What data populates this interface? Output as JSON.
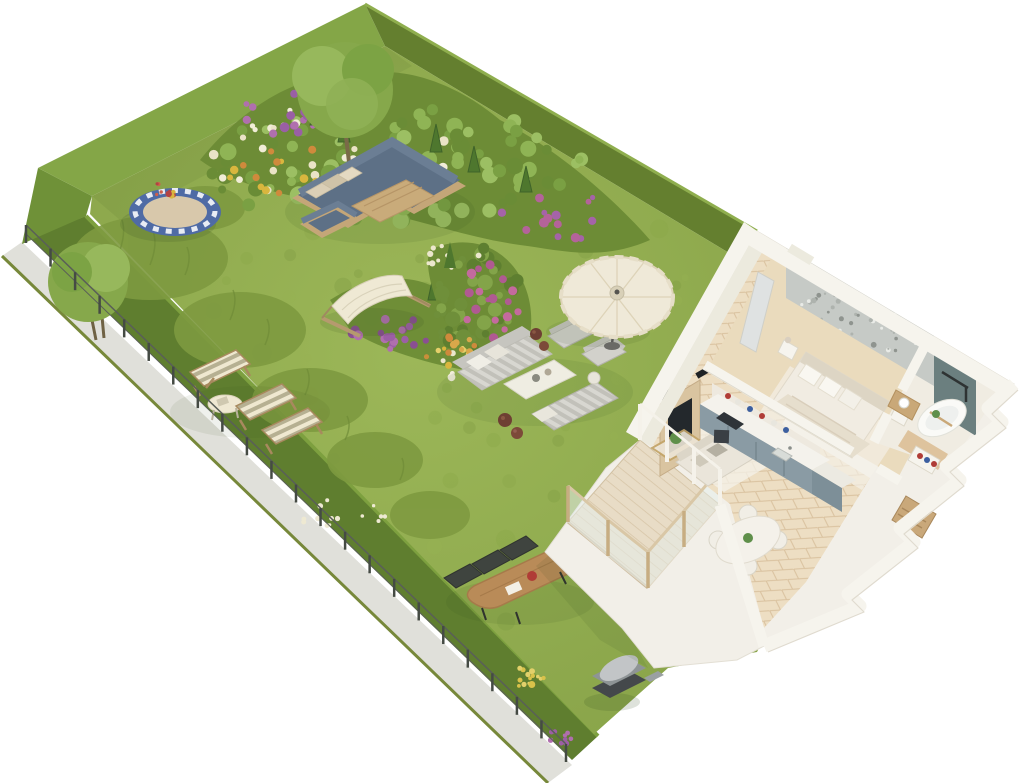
{
  "scene": {
    "kind": "isometric-3d-floor-plan-render",
    "background": "#ffffff"
  },
  "colors": {
    "lawn": "#93ad4f",
    "lawn_light": "#9cb758",
    "hedge_bright": "#84a647",
    "hedge_mid": "#6f9138",
    "hedge_dark": "#647f2f",
    "hedge_low": "#5f7e2f",
    "path": "#e0e0da",
    "path_edge": "#77883a",
    "fence_post": "#454b44",
    "fence_rail": "#5a5f58",
    "bed_base": "#6d8c36",
    "conifer": "#4e772e",
    "tree_canopy": "#86a84b",
    "tree_canopy_light": "#97b85c",
    "trunk": "#7a6a48",
    "tall_grass": "#7e9a40",
    "trampoline_rim": "#4f6ba5",
    "trampoline_mat": "#d8c8ab",
    "sofa_blue": "#5d7086",
    "sofa_blue_back": "#6b7e94",
    "wood_frame": "#c4a678",
    "wood_table": "#c9ab7a",
    "pillow_beige": "#dbcfb6",
    "hammock_canvas": "#efe9d4",
    "lounge_gray": "#d2d1cb",
    "lounge_back": "#c6c5bf",
    "pot_brown": "#6e3f33",
    "umbrella_canvas": "#efe9d8",
    "deckchair_cream": "#efe8d0",
    "deckchair_olive": "#b6b092",
    "garden_table_wood": "#b98b58",
    "garden_chair_dark": "#3f443f",
    "teapot_red": "#b03c36",
    "grill_dark": "#44484b",
    "grill_hood": "#c2c5c7",
    "wall_top": "#f6f4ed",
    "wall_face": "#eceade",
    "house_base": "#f2efe8",
    "floor_parquet": "#eddec3",
    "floor_line": "#d9c19e",
    "deck": "#e8dcc6",
    "glass": "#e6efec",
    "railing_wood": "#c7ad82",
    "kitchen_cabinet": "#8a9ba4",
    "kitchen_island": "#7d8f98",
    "counter": "#f4f2ec",
    "appliance_dark": "#2e3338",
    "accent_wall": "#c6cac6",
    "bed_linen": "#f1ece2",
    "blanket": "#e6decd",
    "headboard": "#ddd5c4",
    "rug": "#f4f1ea",
    "slate_wall": "#6b7f7f",
    "tub_white": "#fafaf7",
    "vanity_wood": "#c9a878",
    "closet_wood": "#c9a87a",
    "mirror": "#dfe2e2",
    "sofa_cream": "#eae5da",
    "tv_dark": "#23282c",
    "tv_panel_wood": "#d9c4a0",
    "dining_white": "#f4f1ea",
    "plant_green": "#5f8f4a",
    "shadow": "#2f4a1f"
  },
  "garden": {
    "items": [
      "perimeter-hedge",
      "perimeter-path",
      "wire-fence",
      "lawn",
      "flower-bed-top",
      "flower-bed-middle",
      "flower-bed-right",
      "tree-top",
      "tree-left",
      "trampoline",
      "corner-sofa-set",
      "outdoor-coffee-table",
      "outdoor-armchair",
      "hammock",
      "lounge-sofa",
      "lounge-armchairs",
      "lounge-table",
      "sun-lounger",
      "clay-pots",
      "parasol-umbrella",
      "deck-chairs",
      "side-table",
      "garden-dining-table",
      "garden-dining-chairs",
      "barbecue-grill"
    ]
  },
  "apartment": {
    "rooms": [
      "living-room",
      "kitchen",
      "dining-area",
      "bedroom",
      "bathroom",
      "hallway",
      "terrace"
    ],
    "furniture": [
      "tv-wall-unit",
      "sofa",
      "coffee-table",
      "round-dining-table",
      "kitchen-counter",
      "cooktop",
      "oven",
      "sink",
      "double-bed",
      "nightstands",
      "wardrobe-mirror",
      "freestanding-bathtub",
      "shower-fixture",
      "vanity-basin",
      "towel-niche",
      "closet-nook",
      "glass-balustrade"
    ]
  },
  "decorations": {
    "fence": {
      "x1": 26,
      "y1": 243,
      "x2": 566,
      "y2": 762,
      "posts": 22,
      "height": 18
    },
    "clusters": [
      {
        "target": "bed-top-green",
        "cx": 390,
        "cy": 165,
        "rx": 195,
        "ry": 58,
        "count": 90,
        "rmin": 4,
        "rmax": 9,
        "colors": [
          "#7aa043",
          "#8fb455",
          "#6a8c36",
          "#9cbf63"
        ],
        "seed": 7
      },
      {
        "target": "bed-top-cream",
        "cx": 330,
        "cy": 150,
        "rx": 150,
        "ry": 45,
        "count": 40,
        "rmin": 2.5,
        "rmax": 5,
        "colors": [
          "#eae3c6",
          "#f1edd7"
        ],
        "seed": 11
      },
      {
        "target": "bed-top-purple",
        "cx": 296,
        "cy": 116,
        "rx": 58,
        "ry": 24,
        "count": 16,
        "rmin": 2.5,
        "rmax": 5,
        "colors": [
          "#9a5fa5",
          "#b06fae"
        ],
        "seed": 13
      },
      {
        "target": "bed-top-yellow",
        "cx": 300,
        "cy": 172,
        "rx": 85,
        "ry": 26,
        "count": 22,
        "rmin": 2.5,
        "rmax": 4.5,
        "colors": [
          "#d9b63e",
          "#cf8a3c"
        ],
        "seed": 17
      },
      {
        "target": "bed-top-purple2",
        "cx": 556,
        "cy": 214,
        "rx": 55,
        "ry": 28,
        "count": 14,
        "rmin": 2.5,
        "rmax": 5,
        "colors": [
          "#a563a8",
          "#b4639a"
        ],
        "seed": 19
      },
      {
        "target": "bed-mid-purple",
        "cx": 392,
        "cy": 332,
        "rx": 44,
        "ry": 20,
        "count": 20,
        "rmin": 2.5,
        "rmax": 5,
        "colors": [
          "#9c5fa5",
          "#8a4f92",
          "#b06fae"
        ],
        "seed": 23
      },
      {
        "target": "bed-mid-yellow",
        "cx": 448,
        "cy": 348,
        "rx": 40,
        "ry": 18,
        "count": 18,
        "rmin": 2,
        "rmax": 4,
        "colors": [
          "#d9b63e",
          "#c98f3a",
          "#e5cf6a"
        ],
        "seed": 29
      },
      {
        "target": "bed-mid-white",
        "cx": 472,
        "cy": 366,
        "rx": 34,
        "ry": 16,
        "count": 14,
        "rmin": 2,
        "rmax": 4,
        "colors": [
          "#ece7cd",
          "#f2eedb"
        ],
        "seed": 31
      },
      {
        "target": "bed-right-green",
        "cx": 472,
        "cy": 298,
        "rx": 48,
        "ry": 52,
        "count": 46,
        "rmin": 3.5,
        "rmax": 8,
        "colors": [
          "#6f8f3a",
          "#83a449",
          "#5e7f30"
        ],
        "seed": 37
      },
      {
        "target": "bed-right-magenta",
        "cx": 494,
        "cy": 300,
        "rx": 32,
        "ry": 38,
        "count": 18,
        "rmin": 2.5,
        "rmax": 5,
        "colors": [
          "#b05a92",
          "#c46a9e"
        ],
        "seed": 41
      },
      {
        "target": "bed-right-orange",
        "cx": 470,
        "cy": 348,
        "rx": 32,
        "ry": 18,
        "count": 13,
        "rmin": 2,
        "rmax": 4,
        "colors": [
          "#cf8a3c",
          "#d9a84a"
        ],
        "seed": 43
      },
      {
        "target": "bed-right-white",
        "cx": 452,
        "cy": 256,
        "rx": 28,
        "ry": 16,
        "count": 10,
        "rmin": 2,
        "rmax": 3.5,
        "colors": [
          "#ece7cd"
        ],
        "seed": 47
      },
      {
        "target": "trampoline-flowers",
        "cx": 170,
        "cy": 189,
        "rx": 20,
        "ry": 8,
        "count": 10,
        "rmin": 1.5,
        "rmax": 3.5,
        "colors": [
          "#b34343",
          "#cf5f4a",
          "#d9b63e"
        ],
        "seed": 53
      },
      {
        "target": "bottom-yellow",
        "cx": 520,
        "cy": 678,
        "rx": 24,
        "ry": 10,
        "count": 14,
        "rmin": 1.5,
        "rmax": 3.5,
        "colors": [
          "#d9c24a",
          "#e2d06a"
        ],
        "seed": 59
      },
      {
        "target": "bottom-purple",
        "cx": 562,
        "cy": 736,
        "rx": 15,
        "ry": 8,
        "count": 10,
        "rmin": 1.5,
        "rmax": 3,
        "colors": [
          "#9c5fa5",
          "#b06fae"
        ],
        "seed": 61
      },
      {
        "target": "hedge-specks",
        "cx": 330,
        "cy": 516,
        "rx": 65,
        "ry": 16,
        "count": 14,
        "rmin": 1.5,
        "rmax": 3,
        "colors": [
          "#eee9d2"
        ],
        "seed": 67
      },
      {
        "target": "accent-wall-floral",
        "cx": 860,
        "cy": 318,
        "rx": 74,
        "ry": 40,
        "count": 80,
        "rmin": 1,
        "rmax": 3,
        "colors": [
          "#aeb3ae",
          "#e9ebe7",
          "#8f948f"
        ],
        "seed": 71
      },
      {
        "target": "lawn-mottle",
        "cx": 420,
        "cy": 400,
        "rx": 330,
        "ry": 250,
        "count": 110,
        "rmin": 3,
        "rmax": 10,
        "colors": [
          "#8aa648",
          "#97b254",
          "#7f9c41"
        ],
        "seed": 73,
        "opacity": 0.35
      }
    ]
  }
}
